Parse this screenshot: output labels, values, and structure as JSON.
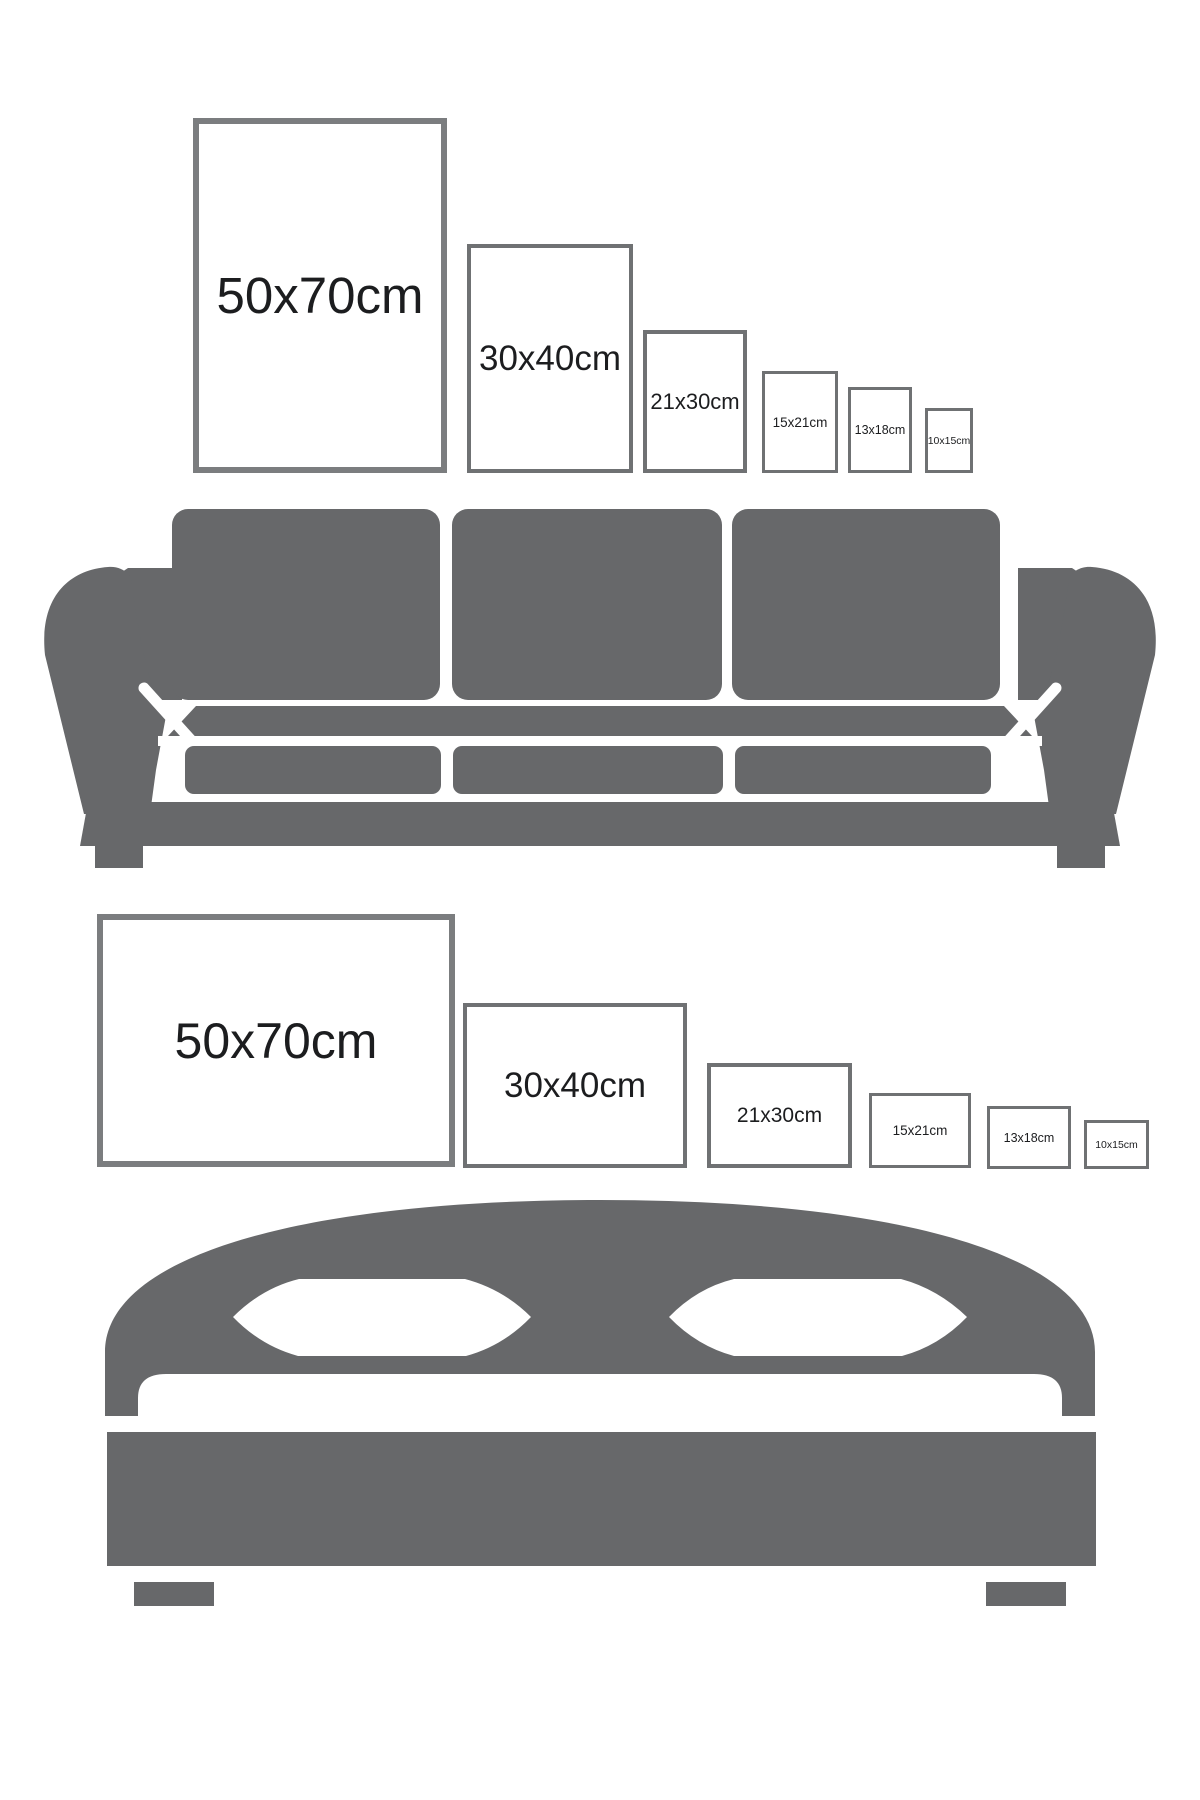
{
  "size_rows": [
    {
      "id": "sofa-row",
      "orientation": "portrait",
      "frames": [
        {
          "label": "50x70cm"
        },
        {
          "label": "30x40cm"
        },
        {
          "label": "21x30cm"
        },
        {
          "label": "15x21cm"
        },
        {
          "label": "13x18cm"
        },
        {
          "label": "10x15cm"
        }
      ]
    },
    {
      "id": "bed-row",
      "orientation": "landscape",
      "frames": [
        {
          "label": "50x70cm"
        },
        {
          "label": "30x40cm"
        },
        {
          "label": "21x30cm"
        },
        {
          "label": "15x21cm"
        },
        {
          "label": "13x18cm"
        },
        {
          "label": "10x15cm"
        }
      ]
    }
  ],
  "illustrations": [
    {
      "name": "sofa-silhouette"
    },
    {
      "name": "bed-silhouette"
    }
  ],
  "colors": {
    "furniture-gray": "#67686a",
    "frame-border-large": "#7b7d7f",
    "frame-border-small": "#6f7173",
    "label-text": "#1c1d1f",
    "background": "#ffffff"
  }
}
